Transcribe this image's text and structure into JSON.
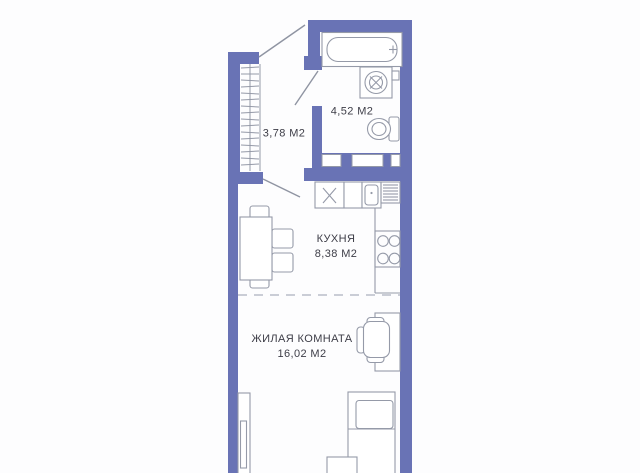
{
  "plan": {
    "type": "apartment-floor-plan",
    "units": "М2",
    "rooms": {
      "hallway": {
        "area_label": "3,78 М2"
      },
      "bathroom": {
        "area_label": "4,52 М2"
      },
      "kitchen": {
        "name": "КУХНЯ",
        "area_label": "8,38 М2"
      },
      "living_room": {
        "name": "ЖИЛАЯ КОМНАТА",
        "area_label": "16,02 М2"
      }
    },
    "fixtures": [
      "bathtub",
      "washing-machine",
      "toilet",
      "closet-hangers",
      "kitchen-sink",
      "dish-drainer",
      "stove",
      "dining-table",
      "chairs",
      "desk",
      "office-chair",
      "bed",
      "wardrobe"
    ],
    "colors": {
      "wall": "#6973b5",
      "furniture_line": "#959aa8",
      "zone_divider": "#b9bdc9",
      "text": "#3d3d47",
      "background": "#ffffff"
    }
  }
}
